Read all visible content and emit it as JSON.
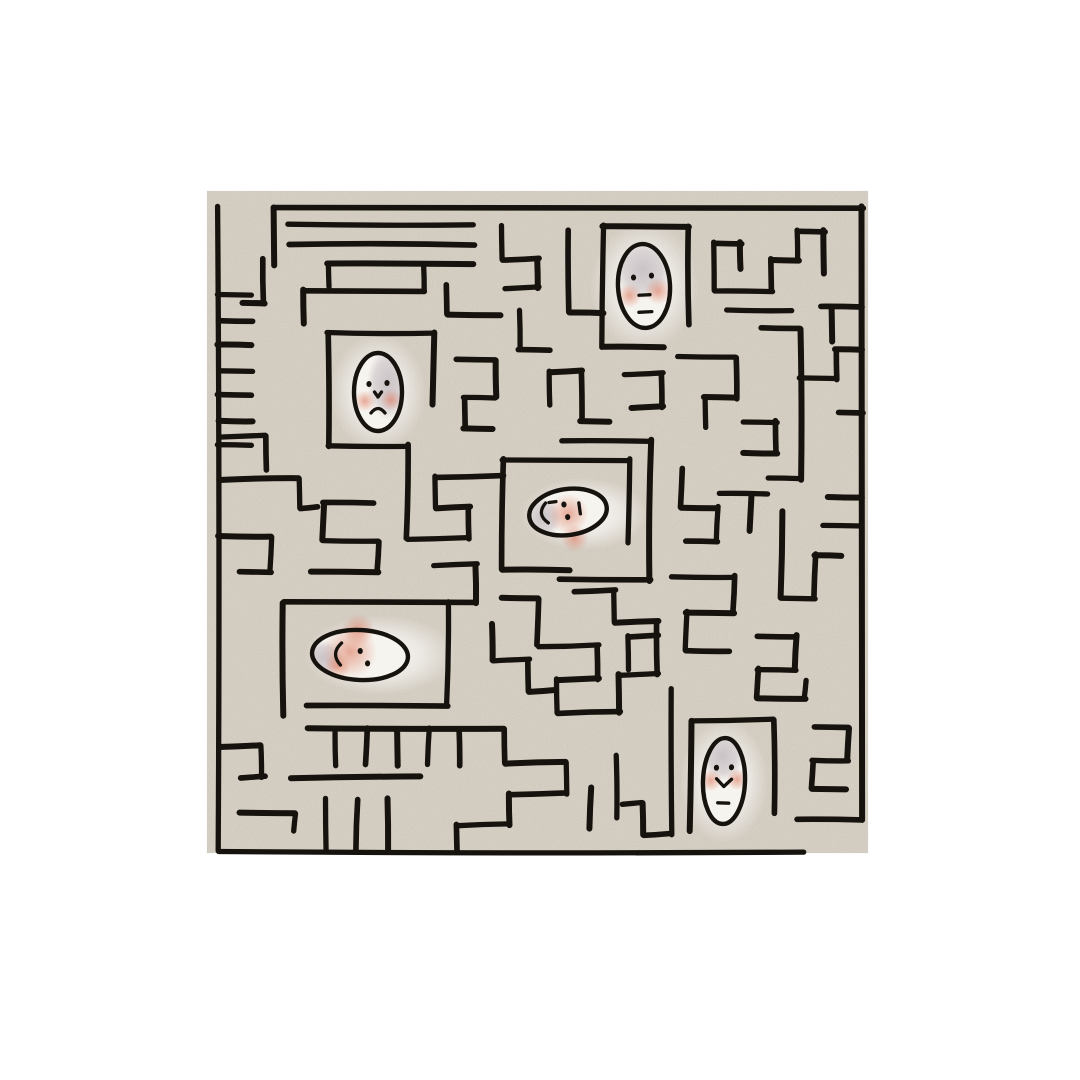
{
  "canvas": {
    "width": 1080,
    "height": 1080,
    "background_color": "#ffffff"
  },
  "paper": {
    "x": 207,
    "y": 191,
    "width": 661,
    "height": 662,
    "color": "#d7d0c5",
    "grain_opacity": 0.38
  },
  "colors": {
    "ink": "#16120d",
    "skin": "#f6f4ef",
    "shade": "#b3a8b1",
    "blush": "#de7e64",
    "glow": "#ffffff"
  },
  "maze": {
    "origin_x": 218.5,
    "origin_y": 207,
    "cell": 23.85,
    "cols": 27,
    "rows": 27,
    "stroke_width": 5.6,
    "entrance": "top-left",
    "exit": "bottom-right",
    "walls": [
      [
        0,
        0,
        0,
        27
      ],
      [
        2.3,
        0,
        27,
        0
      ],
      [
        27,
        0,
        27,
        25.7
      ],
      [
        0,
        27,
        24.5,
        27
      ],
      [
        24.3,
        25.7,
        27,
        25.7
      ],
      [
        2.3,
        0,
        2.3,
        2.4
      ],
      [
        2.95,
        0.75,
        10.7,
        0.75
      ],
      [
        2.95,
        1.55,
        10.7,
        1.55
      ],
      [
        4.6,
        2.4,
        10.7,
        2.4
      ],
      [
        4.6,
        2.4,
        4.6,
        3.3
      ],
      [
        1.9,
        2.2,
        1.9,
        4.0
      ],
      [
        1.0,
        4.0,
        1.9,
        4.0
      ],
      [
        0,
        3.7,
        1.4,
        3.7
      ],
      [
        0,
        4.75,
        1.4,
        4.75
      ],
      [
        0,
        5.8,
        1.4,
        5.8
      ],
      [
        0,
        6.85,
        1.4,
        6.85
      ],
      [
        0,
        7.9,
        1.4,
        7.9
      ],
      [
        0,
        8.95,
        1.4,
        8.95
      ],
      [
        0,
        10.0,
        1.4,
        10.0
      ],
      [
        3.6,
        3.5,
        8.6,
        3.5
      ],
      [
        3.6,
        3.5,
        3.6,
        4.9
      ],
      [
        8.6,
        2.4,
        8.6,
        3.5
      ],
      [
        9.6,
        3.3,
        9.6,
        4.5
      ],
      [
        9.6,
        4.5,
        11.8,
        4.5
      ],
      [
        4.6,
        5.3,
        9.0,
        5.3
      ],
      [
        4.6,
        5.3,
        4.6,
        10.0
      ],
      [
        9.0,
        5.3,
        9.0,
        8.3
      ],
      [
        4.6,
        10.0,
        7.9,
        10.0
      ],
      [
        7.9,
        10.0,
        7.9,
        13.9
      ],
      [
        16.1,
        0.8,
        19.7,
        0.8
      ],
      [
        16.1,
        0.8,
        16.1,
        5.9
      ],
      [
        19.7,
        0.8,
        19.7,
        4.9
      ],
      [
        16.1,
        5.9,
        18.7,
        5.9
      ],
      [
        11.9,
        10.6,
        17.2,
        10.6
      ],
      [
        11.9,
        10.6,
        11.9,
        15.2
      ],
      [
        11.9,
        15.2,
        14.7,
        15.2
      ],
      [
        17.2,
        10.6,
        17.2,
        14.1
      ],
      [
        14.3,
        15.6,
        18.1,
        15.6
      ],
      [
        18.1,
        9.8,
        18.1,
        15.7
      ],
      [
        14.4,
        9.8,
        18.1,
        9.8
      ],
      [
        2.7,
        16.6,
        10.8,
        16.6
      ],
      [
        2.7,
        16.6,
        2.7,
        21.3
      ],
      [
        9.6,
        16.6,
        9.6,
        20.9
      ],
      [
        3.7,
        20.9,
        9.6,
        20.9
      ],
      [
        3.7,
        21.9,
        12.0,
        21.9
      ],
      [
        4.9,
        21.9,
        4.9,
        23.4
      ],
      [
        6.2,
        21.9,
        6.2,
        23.4
      ],
      [
        7.5,
        21.9,
        7.5,
        23.4
      ],
      [
        8.8,
        21.9,
        8.8,
        23.4
      ],
      [
        10.1,
        21.9,
        10.1,
        23.4
      ],
      [
        3.0,
        23.9,
        8.5,
        23.9
      ],
      [
        4.5,
        24.8,
        4.5,
        27
      ],
      [
        5.8,
        24.8,
        5.8,
        27
      ],
      [
        7.1,
        24.8,
        7.1,
        27
      ],
      [
        0,
        9.6,
        2.0,
        9.6
      ],
      [
        2.0,
        9.6,
        2.0,
        11.0
      ],
      [
        0,
        11.4,
        3.4,
        11.4
      ],
      [
        3.4,
        11.4,
        3.4,
        12.6
      ],
      [
        3.4,
        12.6,
        4.2,
        12.6
      ],
      [
        0,
        13.8,
        2.2,
        13.8
      ],
      [
        2.2,
        13.8,
        2.2,
        15.3
      ],
      [
        0.9,
        15.3,
        2.2,
        15.3
      ],
      [
        0,
        22.6,
        1.8,
        22.6
      ],
      [
        1.8,
        22.6,
        1.8,
        23.9
      ],
      [
        0.9,
        23.9,
        2.0,
        23.9
      ],
      [
        0.9,
        25.4,
        3.2,
        25.4
      ],
      [
        3.2,
        25.4,
        3.2,
        26.2
      ],
      [
        4.4,
        12.4,
        6.5,
        12.4
      ],
      [
        4.4,
        12.4,
        4.4,
        14.0
      ],
      [
        4.4,
        14.0,
        6.7,
        14.0
      ],
      [
        6.7,
        14.0,
        6.7,
        15.3
      ],
      [
        3.9,
        15.3,
        6.7,
        15.3
      ],
      [
        7.9,
        13.9,
        10.5,
        13.9
      ],
      [
        10.5,
        12.6,
        10.5,
        13.9
      ],
      [
        9.1,
        12.6,
        10.5,
        12.6
      ],
      [
        9.1,
        11.3,
        9.1,
        12.6
      ],
      [
        9.1,
        11.3,
        11.9,
        11.3
      ],
      [
        10.8,
        15.0,
        10.8,
        16.6
      ],
      [
        9.0,
        15.0,
        10.8,
        15.0
      ],
      [
        10.0,
        6.4,
        11.6,
        6.4
      ],
      [
        11.6,
        6.4,
        11.6,
        8.0
      ],
      [
        10.3,
        8.0,
        11.6,
        8.0
      ],
      [
        10.3,
        8.0,
        10.3,
        9.3
      ],
      [
        10.3,
        9.3,
        11.5,
        9.3
      ],
      [
        12.6,
        4.3,
        12.6,
        6.0
      ],
      [
        12.6,
        6.0,
        13.9,
        6.0
      ],
      [
        13.9,
        6.9,
        15.2,
        6.9
      ],
      [
        13.9,
        6.9,
        13.9,
        8.3
      ],
      [
        15.2,
        6.9,
        15.2,
        9.0
      ],
      [
        15.2,
        9.0,
        16.4,
        9.0
      ],
      [
        17.0,
        7.0,
        18.6,
        7.0
      ],
      [
        18.6,
        7.0,
        18.6,
        8.4
      ],
      [
        17.3,
        8.4,
        18.6,
        8.4
      ],
      [
        11.9,
        0.8,
        11.9,
        2.2
      ],
      [
        11.9,
        2.2,
        13.4,
        2.2
      ],
      [
        13.4,
        2.2,
        13.4,
        3.4
      ],
      [
        12.0,
        3.4,
        13.4,
        3.4
      ],
      [
        14.7,
        1.0,
        14.7,
        4.4
      ],
      [
        14.7,
        4.4,
        16.1,
        4.4
      ],
      [
        20.8,
        1.5,
        20.8,
        3.5
      ],
      [
        20.8,
        1.5,
        21.9,
        1.5
      ],
      [
        21.9,
        1.5,
        21.9,
        2.6
      ],
      [
        20.8,
        3.5,
        23.2,
        3.5
      ],
      [
        23.2,
        2.2,
        23.2,
        3.5
      ],
      [
        23.2,
        2.2,
        24.3,
        2.2
      ],
      [
        24.3,
        1.0,
        24.3,
        2.2
      ],
      [
        24.3,
        1.0,
        25.4,
        1.0
      ],
      [
        25.4,
        1.0,
        25.4,
        2.8
      ],
      [
        21.3,
        4.3,
        24.0,
        4.3
      ],
      [
        25.3,
        4.2,
        27,
        4.2
      ],
      [
        25.7,
        4.2,
        25.7,
        5.6
      ],
      [
        19.3,
        6.3,
        21.7,
        6.3
      ],
      [
        21.7,
        6.3,
        21.7,
        8.0
      ],
      [
        20.4,
        8.0,
        21.7,
        8.0
      ],
      [
        20.4,
        8.0,
        20.4,
        9.2
      ],
      [
        22.8,
        5.1,
        24.4,
        5.1
      ],
      [
        24.4,
        5.1,
        24.4,
        11.4
      ],
      [
        24.4,
        7.2,
        25.9,
        7.2
      ],
      [
        25.9,
        6.0,
        25.9,
        7.2
      ],
      [
        25.9,
        6.0,
        27,
        6.0
      ],
      [
        22.0,
        9.0,
        23.4,
        9.0
      ],
      [
        23.4,
        9.0,
        23.4,
        10.3
      ],
      [
        22.0,
        10.3,
        23.4,
        10.3
      ],
      [
        23.0,
        11.4,
        24.4,
        11.4
      ],
      [
        26.0,
        8.6,
        27,
        8.6
      ],
      [
        25.5,
        12.2,
        27,
        12.2
      ],
      [
        21.0,
        12.0,
        23.0,
        12.0
      ],
      [
        19.4,
        11.0,
        19.4,
        12.6
      ],
      [
        19.4,
        12.6,
        20.9,
        12.6
      ],
      [
        20.9,
        12.6,
        20.9,
        14.0
      ],
      [
        19.6,
        14.0,
        20.9,
        14.0
      ],
      [
        22.3,
        12.2,
        22.3,
        13.6
      ],
      [
        19.0,
        15.5,
        21.6,
        15.5
      ],
      [
        21.6,
        15.5,
        21.6,
        17.0
      ],
      [
        19.6,
        17.0,
        21.6,
        17.0
      ],
      [
        19.6,
        17.0,
        19.6,
        18.6
      ],
      [
        19.6,
        18.6,
        21.4,
        18.6
      ],
      [
        23.6,
        12.8,
        23.6,
        16.4
      ],
      [
        23.6,
        16.4,
        25.0,
        16.4
      ],
      [
        25.0,
        14.6,
        25.0,
        16.4
      ],
      [
        25.0,
        14.6,
        26.1,
        14.6
      ],
      [
        25.3,
        13.4,
        27,
        13.4
      ],
      [
        22.6,
        18.0,
        24.2,
        18.0
      ],
      [
        24.2,
        18.0,
        24.2,
        19.4
      ],
      [
        22.6,
        19.4,
        24.2,
        19.4
      ],
      [
        22.6,
        19.4,
        22.6,
        20.6
      ],
      [
        22.6,
        20.6,
        24.6,
        20.6
      ],
      [
        24.6,
        19.8,
        24.6,
        20.6
      ],
      [
        25.0,
        21.8,
        26.4,
        21.8
      ],
      [
        26.4,
        21.8,
        26.4,
        23.2
      ],
      [
        24.9,
        23.2,
        26.4,
        23.2
      ],
      [
        24.9,
        23.2,
        24.9,
        24.4
      ],
      [
        24.9,
        24.4,
        26.3,
        24.4
      ],
      [
        19.8,
        21.5,
        23.3,
        21.5
      ],
      [
        23.3,
        21.5,
        23.3,
        25.4
      ],
      [
        19.8,
        21.5,
        19.8,
        26.2
      ],
      [
        19.0,
        20.2,
        19.0,
        26.3
      ],
      [
        17.8,
        26.3,
        19.0,
        26.3
      ],
      [
        17.8,
        25.0,
        17.8,
        26.3
      ],
      [
        16.9,
        25.0,
        17.8,
        25.0
      ],
      [
        12.0,
        21.9,
        12.0,
        23.3
      ],
      [
        12.0,
        23.3,
        14.6,
        23.3
      ],
      [
        14.6,
        23.3,
        14.6,
        24.6
      ],
      [
        12.2,
        24.6,
        14.6,
        24.6
      ],
      [
        12.2,
        24.6,
        12.2,
        25.9
      ],
      [
        10.0,
        25.9,
        12.2,
        25.9
      ],
      [
        10.0,
        25.9,
        10.0,
        27
      ],
      [
        15.6,
        24.3,
        15.6,
        26.1
      ],
      [
        16.7,
        23.0,
        16.7,
        25.6
      ],
      [
        13.4,
        16.4,
        13.4,
        18.4
      ],
      [
        11.9,
        16.4,
        13.4,
        16.4
      ],
      [
        13.4,
        18.4,
        15.9,
        18.4
      ],
      [
        15.9,
        18.4,
        15.9,
        19.8
      ],
      [
        14.2,
        19.8,
        15.9,
        19.8
      ],
      [
        14.2,
        19.8,
        14.2,
        21.2
      ],
      [
        14.2,
        21.2,
        16.8,
        21.2
      ],
      [
        16.8,
        19.6,
        16.8,
        21.2
      ],
      [
        16.8,
        19.6,
        18.4,
        19.6
      ],
      [
        18.4,
        17.4,
        18.4,
        19.6
      ],
      [
        16.6,
        17.4,
        18.4,
        17.4
      ],
      [
        16.6,
        16.1,
        16.6,
        17.4
      ],
      [
        14.9,
        16.1,
        16.6,
        16.1
      ],
      [
        11.5,
        17.5,
        11.5,
        19.0
      ],
      [
        11.5,
        19.0,
        13.0,
        19.0
      ],
      [
        13.0,
        19.0,
        13.0,
        20.3
      ],
      [
        13.0,
        20.3,
        14.0,
        20.3
      ],
      [
        17.2,
        18.0,
        17.2,
        19.4
      ],
      [
        17.2,
        18.0,
        18.4,
        18.0
      ]
    ]
  },
  "faces": [
    {
      "id": "face-top",
      "expression": "neutral",
      "cx": 644,
      "cy": 286,
      "rx": 26,
      "ry": 42,
      "rot": -3,
      "shade": {
        "x": 0,
        "y": -16,
        "rx": 23,
        "ry": 24
      },
      "glow": {
        "x": 0,
        "y": 0,
        "rx": 54,
        "ry": 64
      },
      "blush": [
        {
          "x": -15,
          "y": 9,
          "r": 9
        },
        {
          "x": 14,
          "y": 6,
          "r": 10
        }
      ],
      "features": [
        {
          "t": "dot",
          "x": -10,
          "y": -9
        },
        {
          "t": "dot",
          "x": 8,
          "y": -10
        },
        {
          "t": "hdash",
          "x": 0,
          "y": 9,
          "len": 11
        },
        {
          "t": "hdash",
          "x": 0,
          "y": 26,
          "len": 13
        }
      ]
    },
    {
      "id": "face-upper-left",
      "expression": "frown",
      "cx": 378,
      "cy": 392,
      "rx": 24,
      "ry": 39,
      "rot": 0,
      "shade": {
        "x": 10,
        "y": -8,
        "rx": 17,
        "ry": 29
      },
      "glow": {
        "x": 0,
        "y": 0,
        "rx": 48,
        "ry": 58
      },
      "blush": [
        {
          "x": -13,
          "y": 9,
          "r": 8
        },
        {
          "x": 13,
          "y": 8,
          "r": 8
        }
      ],
      "features": [
        {
          "t": "dot",
          "x": -9,
          "y": -8
        },
        {
          "t": "dot",
          "x": 9,
          "y": -9
        },
        {
          "t": "nose",
          "x": 0,
          "y": 3
        },
        {
          "t": "frown",
          "x": 0,
          "y": 17,
          "w": 14
        }
      ]
    },
    {
      "id": "face-center",
      "expression": "sideways",
      "cx": 568,
      "cy": 512,
      "rx": 39,
      "ry": 23,
      "rot": -8,
      "shade": {
        "x": -25,
        "y": 2,
        "rx": 14,
        "ry": 16
      },
      "glow": {
        "x": 16,
        "y": 2,
        "rx": 64,
        "ry": 36
      },
      "blush": [
        {
          "x": 0,
          "y": 2,
          "r": 15
        },
        {
          "x": 3,
          "y": 27,
          "r": 10
        }
      ],
      "features": [
        {
          "t": "hdash",
          "x": -14,
          "y": -12,
          "len": 7
        },
        {
          "t": "arcleft",
          "x": -25,
          "y": -2,
          "h": 20
        },
        {
          "t": "dot",
          "x": -3,
          "y": -8
        },
        {
          "t": "dot",
          "x": -1,
          "y": 5
        },
        {
          "t": "vdash",
          "x": 12,
          "y": -2,
          "len": 11
        }
      ]
    },
    {
      "id": "face-mid-left",
      "expression": "sideways",
      "cx": 360,
      "cy": 655,
      "rx": 48,
      "ry": 25,
      "rot": 3,
      "shade": {
        "x": -36,
        "y": 5,
        "rx": 16,
        "ry": 14
      },
      "glow": {
        "x": 20,
        "y": 0,
        "rx": 76,
        "ry": 40
      },
      "blush": [
        {
          "x": -10,
          "y": -3,
          "r": 20
        },
        {
          "x": -3,
          "y": -25,
          "r": 12
        },
        {
          "x": -22,
          "y": 12,
          "r": 10
        }
      ],
      "features": [
        {
          "t": "arcleft",
          "x": -23,
          "y": 0,
          "h": 22
        },
        {
          "t": "dot",
          "x": 0,
          "y": -4
        },
        {
          "t": "dot",
          "x": 8,
          "y": 8
        }
      ]
    },
    {
      "id": "face-bottom-right",
      "expression": "smile",
      "cx": 724,
      "cy": 781,
      "rx": 21,
      "ry": 43,
      "rot": 2,
      "shade": {
        "x": -2,
        "y": -25,
        "rx": 17,
        "ry": 20
      },
      "glow": {
        "x": 0,
        "y": 0,
        "rx": 44,
        "ry": 62
      },
      "blush": [
        {
          "x": -13,
          "y": 0,
          "r": 8
        },
        {
          "x": 13,
          "y": -2,
          "r": 8
        }
      ],
      "features": [
        {
          "t": "dot",
          "x": -8,
          "y": -13
        },
        {
          "t": "dot",
          "x": 7,
          "y": -14
        },
        {
          "t": "smile",
          "x": 0,
          "y": 1,
          "w": 15
        },
        {
          "t": "hdash",
          "x": 0,
          "y": 22,
          "len": 11
        }
      ]
    }
  ]
}
